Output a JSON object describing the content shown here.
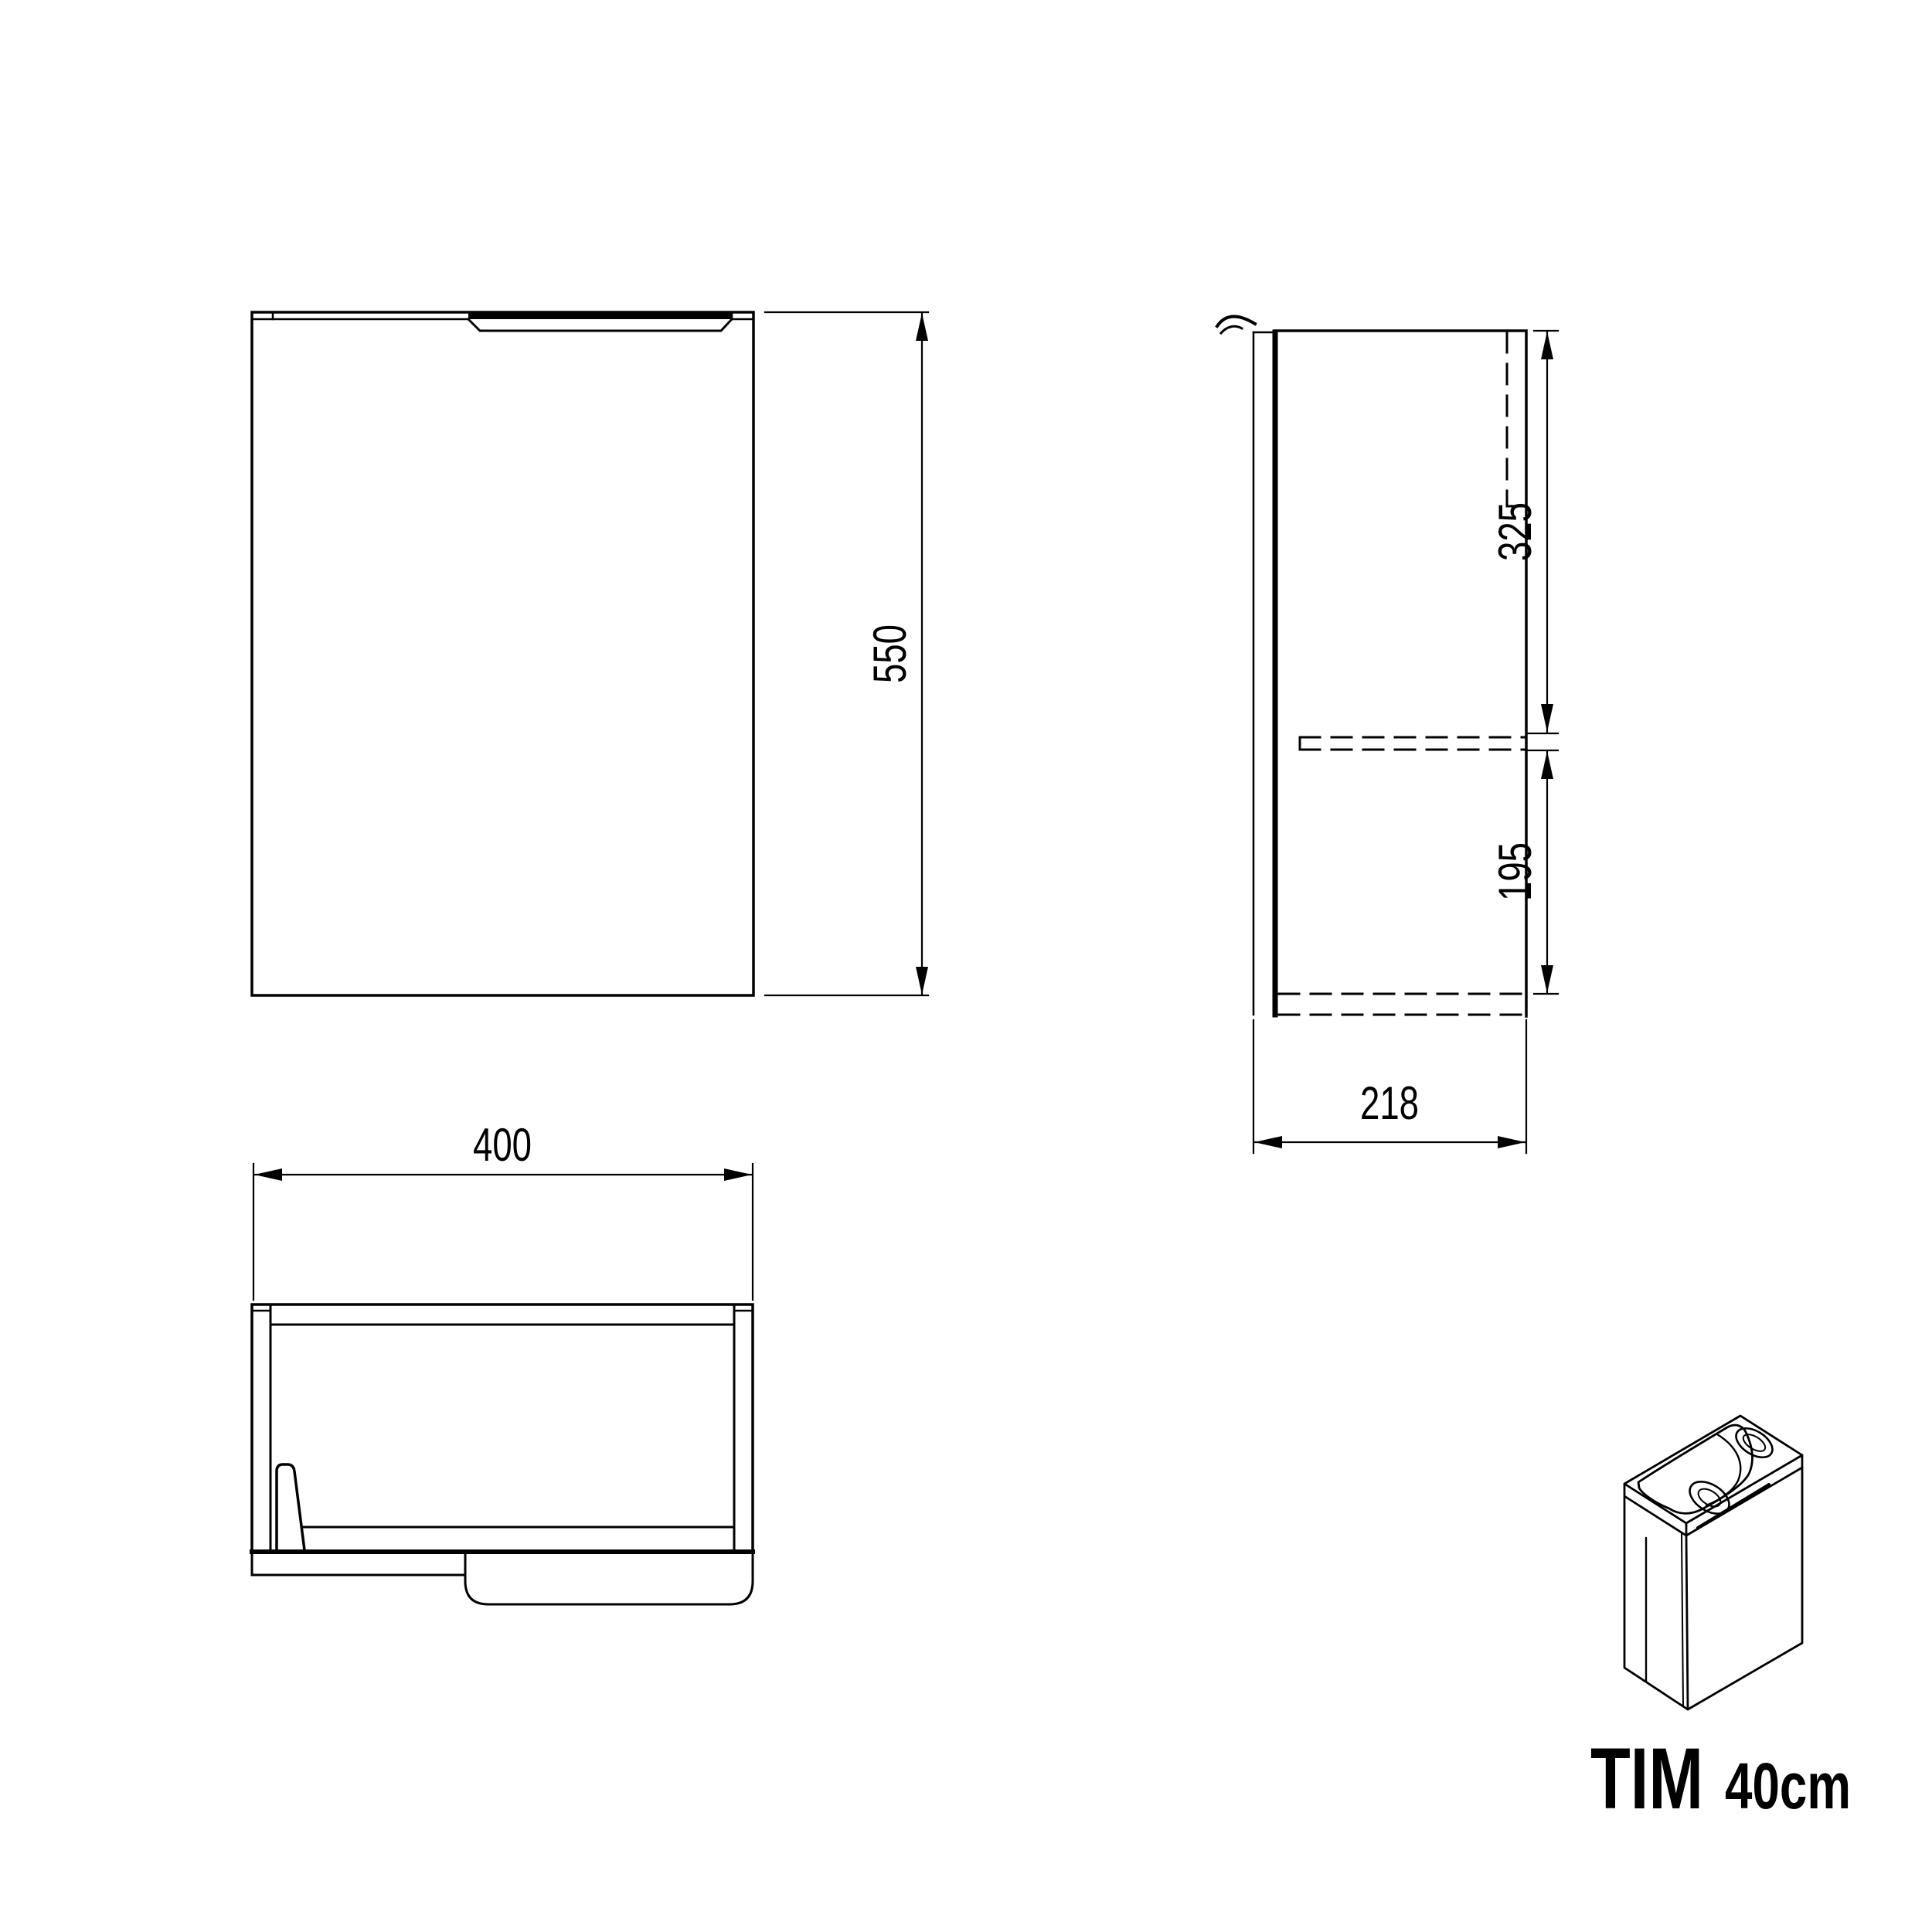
{
  "title": {
    "name": "TIM",
    "size": "40cm"
  },
  "dimensions": {
    "front_height": "550",
    "top_width": "400",
    "side_upper": "325",
    "side_lower": "195",
    "side_depth": "218"
  },
  "views": {
    "front": "front-view",
    "side": "side-view",
    "top": "top-view",
    "sketch": "isometric-product-sketch"
  },
  "colors": {
    "line": "#000000",
    "background": "#ffffff"
  }
}
